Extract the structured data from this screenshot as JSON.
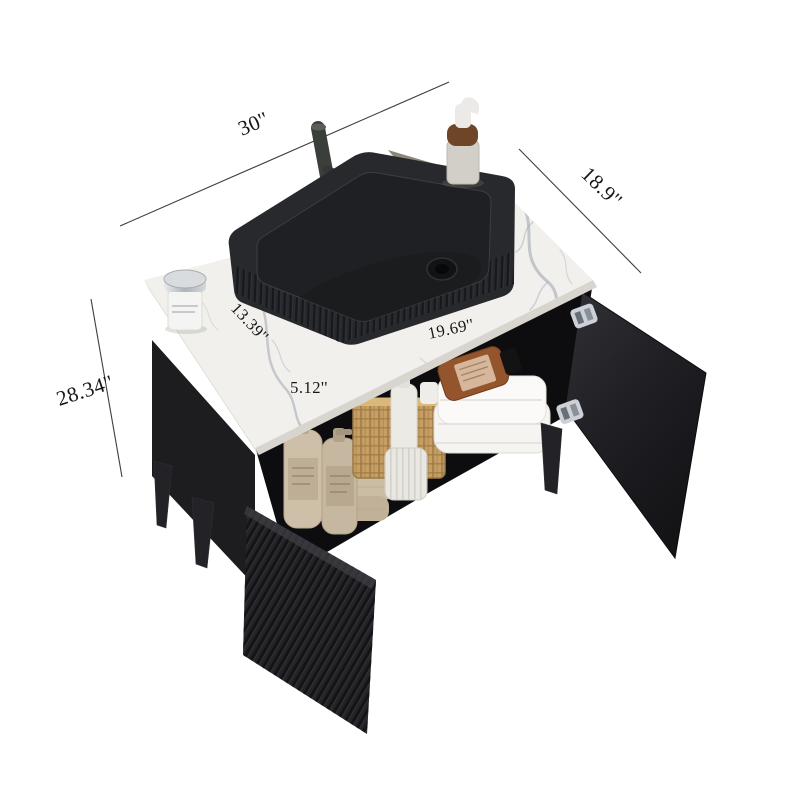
{
  "image": {
    "subject": "bathroom vanity cabinet with vessel sink, top-front view with dimension callouts",
    "background": "#ffffff"
  },
  "dimensions": {
    "top_width": "30''",
    "top_depth": "18.9''",
    "overall_height": "28.34''",
    "countertop_left_edge": "13.39''",
    "countertop_right_edge": "19.69''",
    "countertop_front": "5.12''"
  },
  "colors": {
    "background": "#ffffff",
    "dimension_line": "#3f3f3f",
    "dimension_text": "#161616",
    "marble": "#f1f0ec",
    "marble_shadow": "#8d8779",
    "marble_vein": "#a9aeb8",
    "cabinet_body": "#1d1d20",
    "cabinet_interior": "#0d0d10",
    "door_black": "#242428",
    "sink_body": "#27292d",
    "sink_basin": "#1e2023",
    "faucet_metal": "#3b3f3c",
    "hinge_metal": "#ccd1d7",
    "rattan_basket": "#c79f63",
    "beige_towel": "#d5c7b0",
    "beige_bottle": "#cdbfa8",
    "white_towel": "#f6f4f1",
    "amber_bottle": "#95552c",
    "white_accessory": "#efedea"
  }
}
